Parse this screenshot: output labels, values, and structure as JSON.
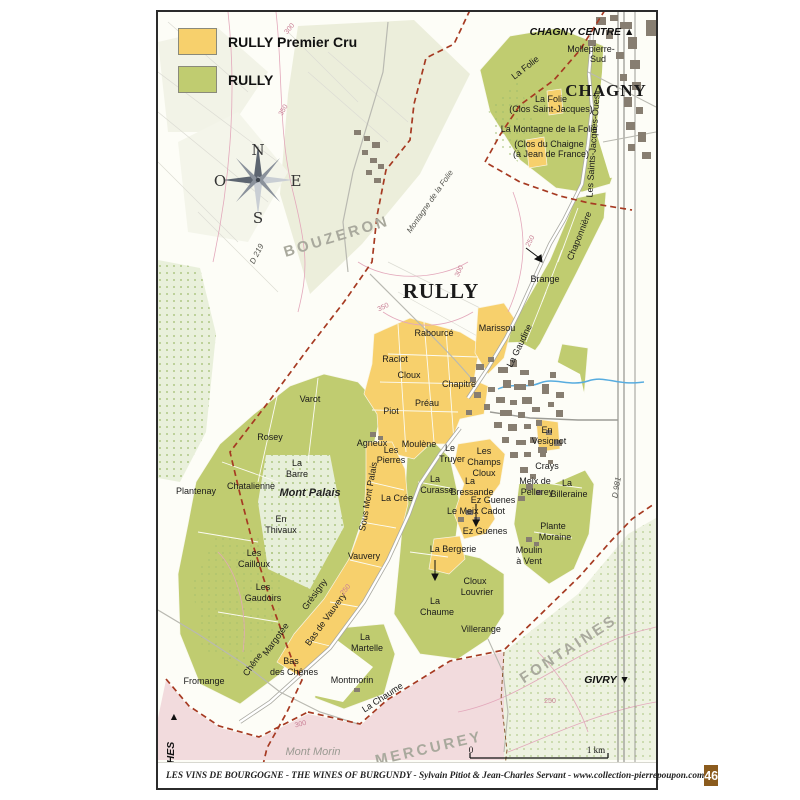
{
  "legend": {
    "items": [
      {
        "label": "RULLY Premier Cru",
        "color": "#F7D06C"
      },
      {
        "label": "RULLY",
        "color": "#C0CC70"
      }
    ]
  },
  "footer": {
    "credit": "LES VINS DE BOURGOGNE  -  THE WINES OF BURGUNDY  -  Sylvain Pitiot & Jean-Charles Servant  -  www.collection-pierrepoupon.com",
    "page_number": "46"
  },
  "scale": {
    "start": "0",
    "end": "1 km"
  },
  "colors": {
    "premier_cru": "#F7D06C",
    "village": "#C0CC70",
    "woodland": "#E9F0DB",
    "town_buildings": "#877E71",
    "boundary_dashed": "#A63A22",
    "contour": "#E3A8BB",
    "stream": "#57ACDF",
    "mercurey_zone": "#F2DBDD",
    "page_number_box": "#8B5B1D"
  },
  "labels": [
    {
      "t": "N",
      "x": 100,
      "y": 143,
      "cls": "compass",
      "n": "compass-n"
    },
    {
      "t": "E",
      "x": 138,
      "y": 174,
      "cls": "compass",
      "n": "compass-e"
    },
    {
      "t": "S",
      "x": 100,
      "y": 211,
      "cls": "compass",
      "n": "compass-s"
    },
    {
      "t": "O",
      "x": 62,
      "y": 174,
      "cls": "compass",
      "n": "compass-w"
    },
    {
      "t": "CHAGNY CENTRE ▲",
      "x": 424,
      "y": 23,
      "cls": "dir",
      "n": "dir-chagny-centre"
    },
    {
      "t": "GIVRY ▼",
      "x": 449,
      "y": 671,
      "cls": "dir",
      "n": "dir-givry"
    },
    {
      "t": "COUCHES",
      "x": 16,
      "y": 756,
      "r": -90,
      "cls": "dir",
      "n": "dir-couches"
    },
    {
      "t": "▲",
      "x": 16,
      "y": 708,
      "cls": "dir",
      "n": "dir-couches-arrow"
    },
    {
      "t": "RULLY",
      "x": 283,
      "y": 286,
      "cls": "city",
      "n": "town-rully"
    },
    {
      "t": "CHAGNY",
      "x": 448,
      "y": 84,
      "cls": "city2",
      "n": "town-chagny"
    },
    {
      "t": "BOUZERON",
      "x": 180,
      "y": 229,
      "r": -17,
      "cls": "region",
      "n": "region-bouzeron"
    },
    {
      "t": "FONTAINES",
      "x": 413,
      "y": 641,
      "r": -33,
      "cls": "region",
      "n": "region-fontaines"
    },
    {
      "t": "MERCUREY",
      "x": 272,
      "y": 741,
      "r": -13,
      "cls": "region",
      "n": "region-mercurey"
    },
    {
      "t": "Mont Palais",
      "x": 152,
      "y": 484,
      "cls": "hill",
      "n": "hill-mont-palais"
    },
    {
      "t": "Mont Morin",
      "x": 155,
      "y": 743,
      "cls": "hillg",
      "n": "hill-mont-morin"
    },
    {
      "t": "Montagne de la Folie",
      "x": 274,
      "y": 191,
      "r": -55,
      "cls": "road",
      "n": "hill-montagne-folie"
    },
    {
      "t": "D 219",
      "x": 101,
      "y": 243,
      "r": -63,
      "cls": "road",
      "n": "road-d219"
    },
    {
      "t": "D 981",
      "x": 461,
      "y": 476,
      "r": -80,
      "cls": "road",
      "n": "road-d981"
    },
    {
      "t": "Mollepierre-",
      "x": 433,
      "y": 40,
      "cls": "vine"
    },
    {
      "t": "Sud",
      "x": 440,
      "y": 50,
      "cls": "vine"
    },
    {
      "t": "La Folie",
      "x": 369,
      "y": 58,
      "r": -38,
      "cls": "vine"
    },
    {
      "t": "La Folie",
      "x": 393,
      "y": 90,
      "cls": "vine"
    },
    {
      "t": "(Clos Saint-Jacques)",
      "x": 393,
      "y": 100,
      "cls": "vine"
    },
    {
      "t": "La Montagne de la Folie",
      "x": 391,
      "y": 120,
      "cls": "vine"
    },
    {
      "t": "(Clos du Chaigne",
      "x": 391,
      "y": 135,
      "cls": "vine"
    },
    {
      "t": "(à Jean de France)",
      "x": 393,
      "y": 145,
      "cls": "vine"
    },
    {
      "t": "Les Saints-Jacques-Ouest",
      "x": 438,
      "y": 133,
      "r": -86,
      "cls": "vine"
    },
    {
      "t": "Chaponnière",
      "x": 424,
      "y": 225,
      "r": -68,
      "cls": "vine"
    },
    {
      "t": "Brange",
      "x": 387,
      "y": 270,
      "cls": "vine"
    },
    {
      "t": "Marissou",
      "x": 339,
      "y": 319,
      "cls": "vine"
    },
    {
      "t": "La Gaudine",
      "x": 364,
      "y": 335,
      "r": -64,
      "cls": "vine"
    },
    {
      "t": "Rabourcé",
      "x": 276,
      "y": 324,
      "cls": "vine"
    },
    {
      "t": "Raclot",
      "x": 237,
      "y": 350,
      "cls": "vine"
    },
    {
      "t": "Cloux",
      "x": 251,
      "y": 366,
      "cls": "vine"
    },
    {
      "t": "Chapitre",
      "x": 301,
      "y": 375,
      "cls": "vine"
    },
    {
      "t": "Préau",
      "x": 269,
      "y": 394,
      "cls": "vine"
    },
    {
      "t": "Piot",
      "x": 233,
      "y": 402,
      "cls": "vine"
    },
    {
      "t": "Varot",
      "x": 152,
      "y": 390,
      "cls": "vine"
    },
    {
      "t": "Rosey",
      "x": 112,
      "y": 428,
      "cls": "vine"
    },
    {
      "t": "La",
      "x": 139,
      "y": 454,
      "cls": "vine"
    },
    {
      "t": "Barre",
      "x": 139,
      "y": 465,
      "cls": "vine"
    },
    {
      "t": "Chatalienne",
      "x": 93,
      "y": 477,
      "cls": "vine"
    },
    {
      "t": "Plantenay",
      "x": 38,
      "y": 482,
      "cls": "vine"
    },
    {
      "t": "En",
      "x": 123,
      "y": 510,
      "cls": "vine"
    },
    {
      "t": "Thivaux",
      "x": 123,
      "y": 521,
      "cls": "vine"
    },
    {
      "t": "Les",
      "x": 96,
      "y": 544,
      "cls": "vine"
    },
    {
      "t": "Cailloux",
      "x": 96,
      "y": 555,
      "cls": "vine"
    },
    {
      "t": "Les",
      "x": 105,
      "y": 578,
      "cls": "vine"
    },
    {
      "t": "Gaudoirs",
      "x": 105,
      "y": 589,
      "cls": "vine"
    },
    {
      "t": "Agneux",
      "x": 214,
      "y": 434,
      "cls": "vine"
    },
    {
      "t": "Les",
      "x": 233,
      "y": 441,
      "cls": "vine"
    },
    {
      "t": "Pierres",
      "x": 233,
      "y": 451,
      "cls": "vine"
    },
    {
      "t": "Moulène",
      "x": 261,
      "y": 435,
      "cls": "vine"
    },
    {
      "t": "Sous Mont Palais",
      "x": 213,
      "y": 485,
      "r": -80,
      "cls": "vine"
    },
    {
      "t": "La Crée",
      "x": 239,
      "y": 489,
      "cls": "vine"
    },
    {
      "t": "Vauvery",
      "x": 206,
      "y": 547,
      "cls": "vine"
    },
    {
      "t": "Grésigny",
      "x": 159,
      "y": 584,
      "r": -54,
      "cls": "vine"
    },
    {
      "t": "Bas de Vauvery",
      "x": 170,
      "y": 609,
      "r": -54,
      "cls": "vine"
    },
    {
      "t": "Margotée",
      "x": 120,
      "y": 629,
      "r": -54,
      "cls": "vine"
    },
    {
      "t": "Chêne",
      "x": 97,
      "y": 654,
      "r": -54,
      "cls": "vine"
    },
    {
      "t": "Bas",
      "x": 133,
      "y": 652,
      "cls": "vine"
    },
    {
      "t": "des Chênes",
      "x": 136,
      "y": 663,
      "cls": "vine"
    },
    {
      "t": "Fromange",
      "x": 46,
      "y": 672,
      "cls": "vine"
    },
    {
      "t": "La",
      "x": 207,
      "y": 628,
      "cls": "vine"
    },
    {
      "t": "Martelle",
      "x": 209,
      "y": 639,
      "cls": "vine"
    },
    {
      "t": "Montmorin",
      "x": 194,
      "y": 671,
      "cls": "vine"
    },
    {
      "t": "La Chaume",
      "x": 226,
      "y": 688,
      "r": -33,
      "cls": "vine"
    },
    {
      "t": "Le",
      "x": 292,
      "y": 439,
      "cls": "vine"
    },
    {
      "t": "Truyer",
      "x": 294,
      "y": 450,
      "cls": "vine"
    },
    {
      "t": "Les",
      "x": 326,
      "y": 442,
      "cls": "vine"
    },
    {
      "t": "Champs",
      "x": 326,
      "y": 453,
      "cls": "vine"
    },
    {
      "t": "Cloux",
      "x": 326,
      "y": 464,
      "cls": "vine"
    },
    {
      "t": "La",
      "x": 277,
      "y": 470,
      "cls": "vine"
    },
    {
      "t": "Curasse",
      "x": 279,
      "y": 481,
      "cls": "vine"
    },
    {
      "t": "La",
      "x": 312,
      "y": 472,
      "cls": "vine"
    },
    {
      "t": "Bressande",
      "x": 314,
      "y": 483,
      "cls": "vine"
    },
    {
      "t": "Ez Guenes",
      "x": 335,
      "y": 491,
      "cls": "vine"
    },
    {
      "t": "Le Meix Cadot",
      "x": 318,
      "y": 502,
      "cls": "vine"
    },
    {
      "t": "Ez Guenes",
      "x": 327,
      "y": 522,
      "cls": "vine"
    },
    {
      "t": "La Bergerie",
      "x": 295,
      "y": 540,
      "cls": "vine"
    },
    {
      "t": "Cloux",
      "x": 317,
      "y": 572,
      "cls": "vine"
    },
    {
      "t": "Louvrier",
      "x": 319,
      "y": 583,
      "cls": "vine"
    },
    {
      "t": "La",
      "x": 277,
      "y": 592,
      "cls": "vine"
    },
    {
      "t": "Chaume",
      "x": 279,
      "y": 603,
      "cls": "vine"
    },
    {
      "t": "Villerange",
      "x": 323,
      "y": 620,
      "cls": "vine"
    },
    {
      "t": "En",
      "x": 389,
      "y": 421,
      "cls": "vine"
    },
    {
      "t": "Vesignot",
      "x": 391,
      "y": 432,
      "cls": "vine"
    },
    {
      "t": "Crays",
      "x": 389,
      "y": 457,
      "cls": "vine"
    },
    {
      "t": "Meix de",
      "x": 377,
      "y": 472,
      "cls": "vine"
    },
    {
      "t": "Pellerey",
      "x": 379,
      "y": 483,
      "cls": "vine"
    },
    {
      "t": "La",
      "x": 409,
      "y": 474,
      "cls": "vine"
    },
    {
      "t": "Billeraine",
      "x": 411,
      "y": 485,
      "cls": "vine"
    },
    {
      "t": "Plante",
      "x": 395,
      "y": 517,
      "cls": "vine"
    },
    {
      "t": "Moraine",
      "x": 397,
      "y": 528,
      "cls": "vine"
    },
    {
      "t": "Moulin",
      "x": 371,
      "y": 541,
      "cls": "vine"
    },
    {
      "t": "à Vent",
      "x": 371,
      "y": 552,
      "cls": "vine"
    },
    {
      "t": "300",
      "x": 133,
      "y": 18,
      "r": -50,
      "cls": "contour"
    },
    {
      "t": "350",
      "x": 127,
      "y": 99,
      "r": -60,
      "cls": "contour"
    },
    {
      "t": "350",
      "x": 226,
      "y": 297,
      "r": -25,
      "cls": "contour"
    },
    {
      "t": "300",
      "x": 303,
      "y": 260,
      "r": -65,
      "cls": "contour"
    },
    {
      "t": "250",
      "x": 374,
      "y": 230,
      "r": -62,
      "cls": "contour"
    },
    {
      "t": "250",
      "x": 189,
      "y": 579,
      "r": -50,
      "cls": "contour"
    },
    {
      "t": "300",
      "x": 143,
      "y": 714,
      "r": -15,
      "cls": "contour"
    },
    {
      "t": "250",
      "x": 392,
      "y": 691,
      "cls": "contour"
    },
    {
      "t": "0",
      "x": 313,
      "y": 741,
      "cls": "scale",
      "n": "scale-start"
    },
    {
      "t": "1 km",
      "x": 438,
      "y": 741,
      "cls": "scale",
      "n": "scale-end"
    }
  ]
}
